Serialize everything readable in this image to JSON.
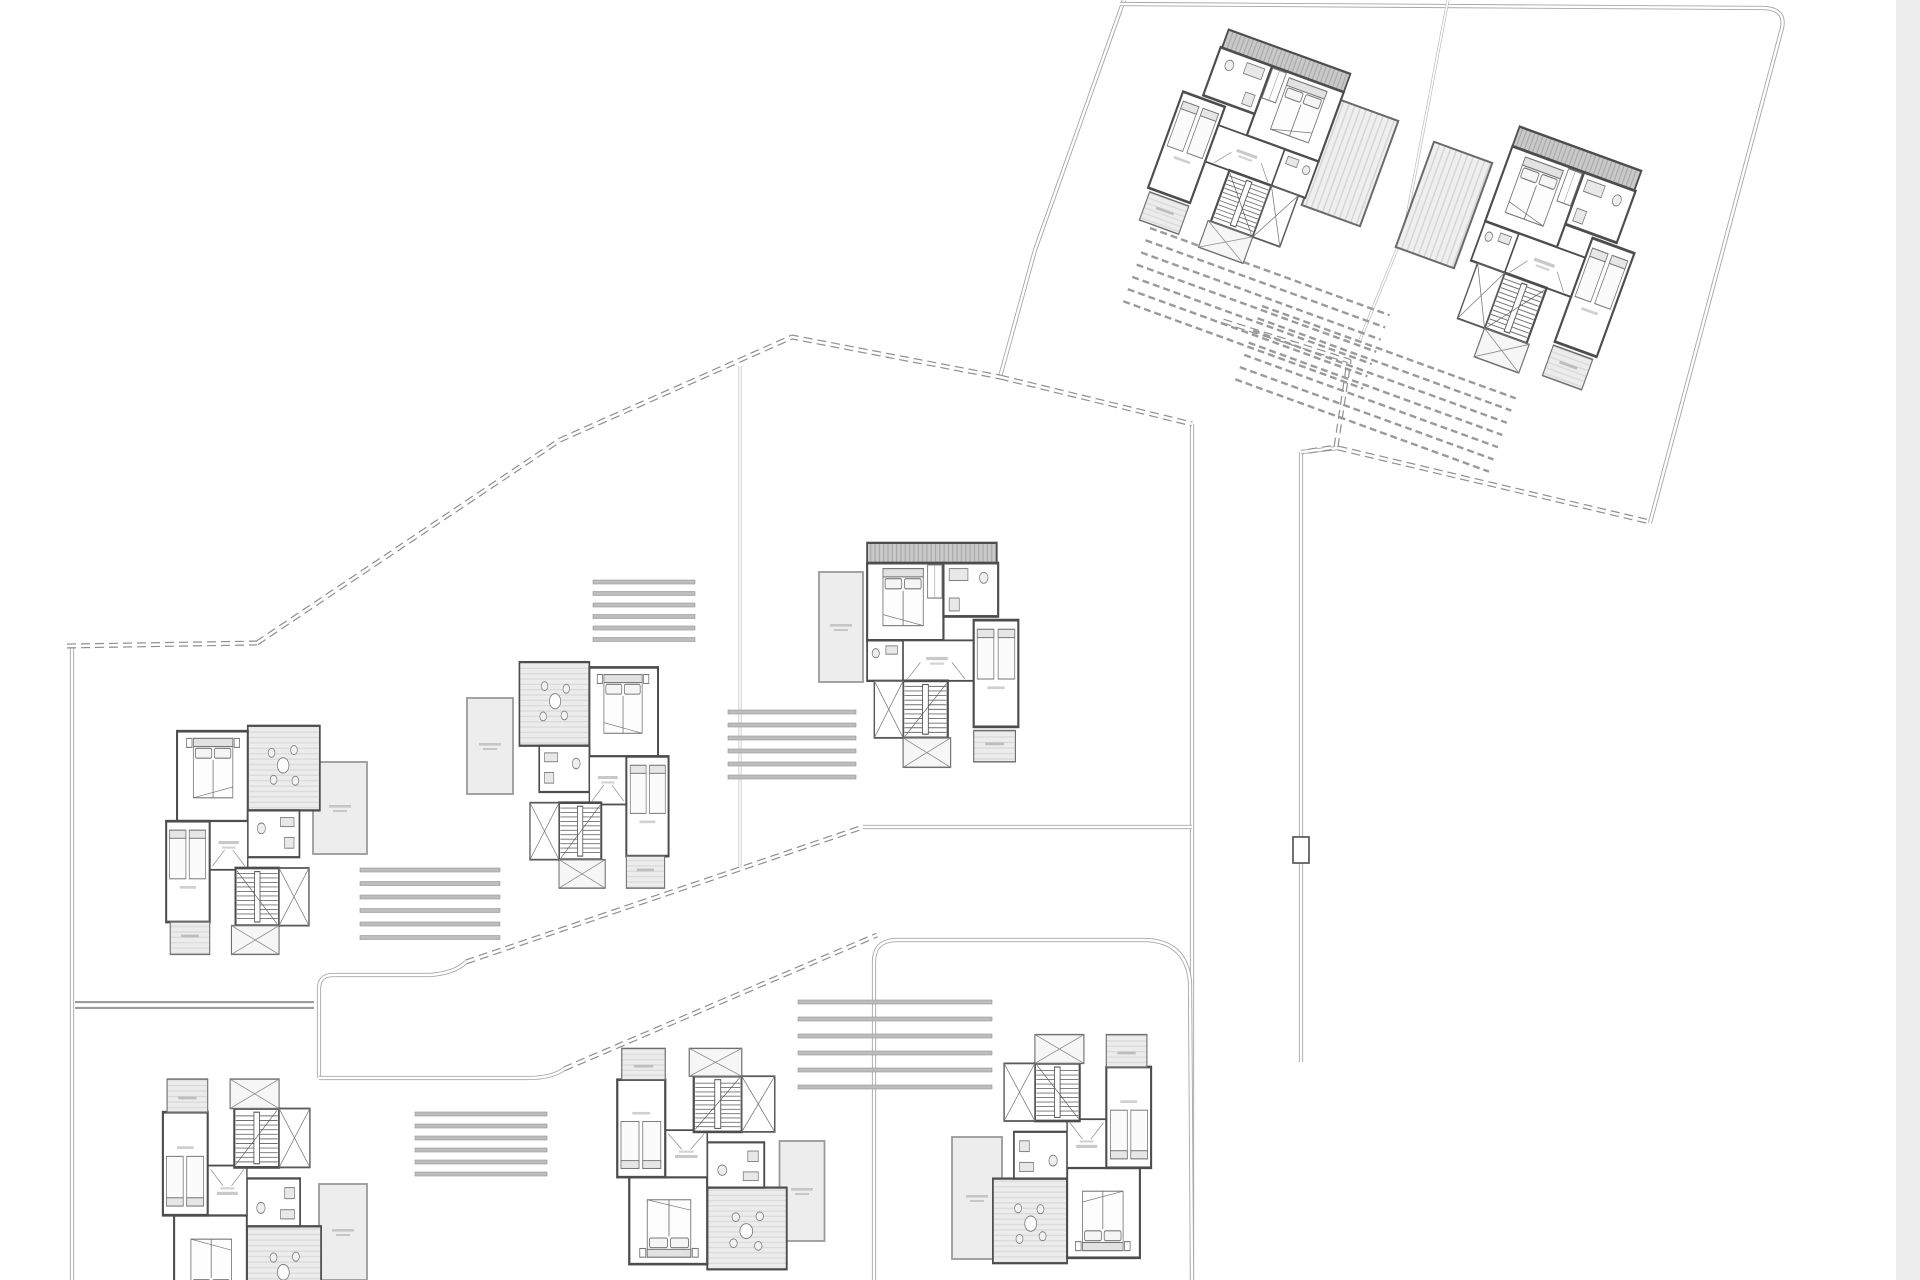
{
  "canvas": {
    "width": 1920,
    "height": 1280,
    "background": "#ffffff"
  },
  "right_margin_band": {
    "x": 1896,
    "y": 0,
    "width": 24,
    "height": 1280,
    "color": "#ededed"
  },
  "palette": {
    "wall": "#4d4d4d",
    "inner_line": "#777777",
    "road_outer": "#a6a6a6",
    "road_inner": "#ffffff",
    "road_heavy_outer": "#9c9c9c",
    "road_thin_outer": "#bcbcbc",
    "dash_outer": "#8f8f8f",
    "single_line": "#c6c6c6",
    "bar_fill": "#bdbdbd",
    "bar_edge": "#949494",
    "hatch_line": "#9a9a9a",
    "terrace_fill": "#ededed",
    "terrace_edge": "#9a9a9a",
    "label_bar": "#c6c6c6"
  },
  "roads": [
    {
      "name": "parcel-tr-west-edge",
      "style": "double",
      "d": "M 1124,0 L 1035,250 L 1000,377"
    },
    {
      "name": "parcel-tr-top-east",
      "style": "double",
      "d": "M 1120,4 L 1764,8 Q 1786,9 1782,28 L 1650,523"
    },
    {
      "name": "parcel-tr-divider",
      "style": "thin",
      "d": "M 1448,0 L 1404,232 L 1360,340"
    },
    {
      "name": "road-v1-east",
      "style": "double",
      "d": "M 1192,424 L 1192,1280"
    },
    {
      "name": "road-v2",
      "style": "double",
      "d": "M 1301,452 L 1301,1062"
    },
    {
      "name": "road-v2-stub",
      "style": "double",
      "d": "M 1301,452 L 1338,448"
    },
    {
      "name": "boundary-west",
      "style": "double",
      "d": "M 72,645 L 72,1280"
    },
    {
      "name": "path-mid-vertical",
      "style": "thin",
      "d": "M 740,366 L 740,868"
    },
    {
      "name": "road-left-horizontal",
      "style": "heavy",
      "d": "M 75,1005 L 314,1005"
    },
    {
      "name": "road-loop-left-top",
      "style": "double",
      "d": "M 319,1078 L 319,989 Q 319,975 333,975 L 430,975 Q 455,973 466,962"
    },
    {
      "name": "road-loop-left-bottom",
      "style": "double",
      "d": "M 319,1078 L 528,1078 Q 552,1078 564,1069"
    },
    {
      "name": "road-loop-house-h",
      "style": "double",
      "d": "M 874,1280 L 874,962 Q 874,940 897,940 L 1143,940 Q 1186,940 1190,982 L 1192,1280"
    },
    {
      "name": "parcel-h-top",
      "style": "double",
      "d": "M 863,827 L 1192,827"
    }
  ],
  "boundaries": [
    {
      "name": "dash-left-horizontal",
      "style": "dash",
      "d": "M 67,646 L 257,643"
    },
    {
      "name": "dash-ribbon-crest",
      "style": "dash",
      "d": "M 257,643 L 560,440 L 792,337 L 1000,377"
    },
    {
      "name": "dash-junction-east",
      "style": "dash",
      "d": "M 1000,377 L 1192,424"
    },
    {
      "name": "dash-step-parcel",
      "style": "dash",
      "d": "M 1223,321 L 1349,361 L 1336,447 L 1303,452"
    },
    {
      "name": "dash-southeast",
      "style": "dash",
      "d": "M 1338,448 L 1650,522"
    },
    {
      "name": "dash-slope-upper",
      "style": "dash",
      "d": "M 466,962 L 863,827"
    },
    {
      "name": "dash-slope-lower",
      "style": "dash",
      "d": "M 564,1069 L 877,935"
    }
  ],
  "gate_marker": {
    "x": 1293,
    "y": 837,
    "width": 16,
    "height": 26
  },
  "stair_flights": [
    {
      "name": "flight-east-of-house-e",
      "x": 360,
      "y": 868,
      "width": 140,
      "count": 6,
      "gap": 13.5,
      "rotation": 0
    },
    {
      "name": "flight-west-of-house-c",
      "x": 728,
      "y": 710,
      "width": 128,
      "count": 6,
      "gap": 13,
      "rotation": 0
    },
    {
      "name": "flight-east-of-house-d",
      "x": 593,
      "y": 580,
      "width": 102,
      "count": 6,
      "gap": 11.5,
      "rotation": 0
    },
    {
      "name": "flight-north-of-house-h",
      "x": 798,
      "y": 1000,
      "width": 194,
      "count": 6,
      "gap": 17,
      "rotation": 0
    },
    {
      "name": "flight-east-of-house-f",
      "x": 415,
      "y": 1112,
      "width": 132,
      "count": 6,
      "gap": 12,
      "rotation": 0
    }
  ],
  "hatch_bar_groups": [
    {
      "name": "driveway-house-a",
      "x": 1150,
      "y": 228,
      "width": 255,
      "count": 7,
      "gap": 13,
      "rotation": 20
    },
    {
      "name": "driveway-house-b",
      "x": 1262,
      "y": 306,
      "width": 270,
      "count": 7,
      "gap": 13,
      "rotation": 20
    }
  ],
  "terraces": [
    {
      "name": "terrace-house-c",
      "cx": 841,
      "cy": 627,
      "width": 44,
      "height": 110,
      "rotation": 0,
      "surface": "plain"
    },
    {
      "name": "terrace-house-d",
      "cx": 490,
      "cy": 746,
      "width": 46,
      "height": 96,
      "rotation": 0,
      "surface": "plain"
    },
    {
      "name": "terrace-house-e",
      "cx": 340,
      "cy": 808,
      "width": 54,
      "height": 92,
      "rotation": 0,
      "surface": "plain"
    },
    {
      "name": "terrace-house-f",
      "cx": 343,
      "cy": 1232,
      "width": 48,
      "height": 96,
      "rotation": 0,
      "surface": "plain"
    },
    {
      "name": "terrace-house-g",
      "cx": 802,
      "cy": 1191,
      "width": 45,
      "height": 100,
      "rotation": 0,
      "surface": "plain"
    },
    {
      "name": "terrace-house-h",
      "cx": 977,
      "cy": 1198,
      "width": 50,
      "height": 122,
      "rotation": 0,
      "surface": "plain"
    },
    {
      "name": "deck-house-a",
      "cx": 1350,
      "cy": 163,
      "width": 62,
      "height": 112,
      "rotation": 20,
      "surface": "striped"
    },
    {
      "name": "deck-house-b",
      "cx": 1444,
      "cy": 205,
      "width": 62,
      "height": 112,
      "rotation": 20,
      "surface": "striped"
    }
  ],
  "houses": [
    {
      "id": "a",
      "type": 1,
      "cx": 1243,
      "cy": 150,
      "rotation": 20,
      "mirror": true,
      "sx": 0.72,
      "sy": 0.88
    },
    {
      "id": "b",
      "type": 1,
      "cx": 1550,
      "cy": 262,
      "rotation": 20,
      "mirror": false,
      "sx": 0.72,
      "sy": 0.95
    },
    {
      "id": "c",
      "type": 1,
      "cx": 942,
      "cy": 656,
      "rotation": 0,
      "mirror": false,
      "sx": 0.72,
      "sy": 0.92
    },
    {
      "id": "d",
      "type": 2,
      "cx": 594,
      "cy": 776,
      "rotation": 0,
      "mirror": false,
      "sx": 0.66,
      "sy": 0.89
    },
    {
      "id": "e",
      "type": 2,
      "cx": 243,
      "cy": 841,
      "rotation": 0,
      "mirror": true,
      "sx": 0.68,
      "sy": 0.9
    },
    {
      "id": "f",
      "type": 2,
      "cx": 242,
      "cy": 1195,
      "rotation": 180,
      "mirror": false,
      "sx": 0.7,
      "sy": 0.92
    },
    {
      "id": "g",
      "type": 2,
      "cx": 702,
      "cy": 1158,
      "rotation": 180,
      "mirror": false,
      "sx": 0.75,
      "sy": 0.87
    },
    {
      "id": "h",
      "type": 2,
      "cx": 1072,
      "cy": 1148,
      "rotation": 180,
      "mirror": true,
      "sx": 0.7,
      "sy": 0.9
    }
  ]
}
